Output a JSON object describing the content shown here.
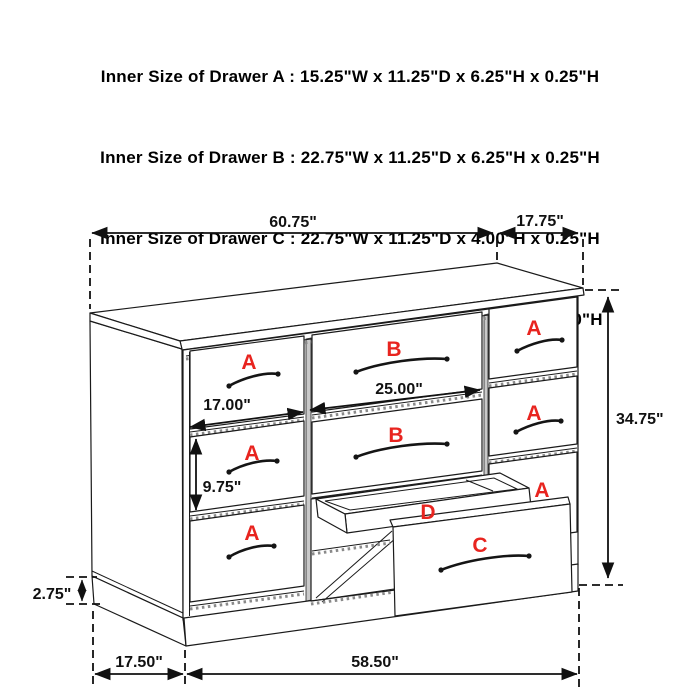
{
  "page": {
    "background": "#ffffff"
  },
  "spec_block": {
    "lines": [
      "Inner Size of Drawer A : 15.25\"W x 11.25\"D x 6.25\"H x 0.25\"H",
      "Inner Size of Drawer B : 22.75\"W x 11.25\"D x 6.25\"H x 0.25\"H",
      "Inner Size of Drawer C : 22.75\"W x 11.25\"D x 4.00\"H x 0.25\"H",
      "Inner Size of Drawer  D : 22.50\"W x 10.75\"D x 1.75\"H x 0.50\"H"
    ]
  },
  "dims": {
    "overall_width": "60.75\"",
    "top_depth": "17.75\"",
    "overall_height": "34.75\"",
    "left_drawer_width": "17.00\"",
    "middle_drawer_width": "25.00\"",
    "left_drawer_height": "9.75\"",
    "base_height": "2.75\"",
    "base_depth": "17.50\"",
    "base_width": "58.50\""
  },
  "drawer_labels": {
    "a": "A",
    "b": "B",
    "c": "C",
    "d": "D"
  },
  "colors": {
    "label_red": "#e8241f",
    "line": "#1a1a1a",
    "background": "#ffffff"
  }
}
